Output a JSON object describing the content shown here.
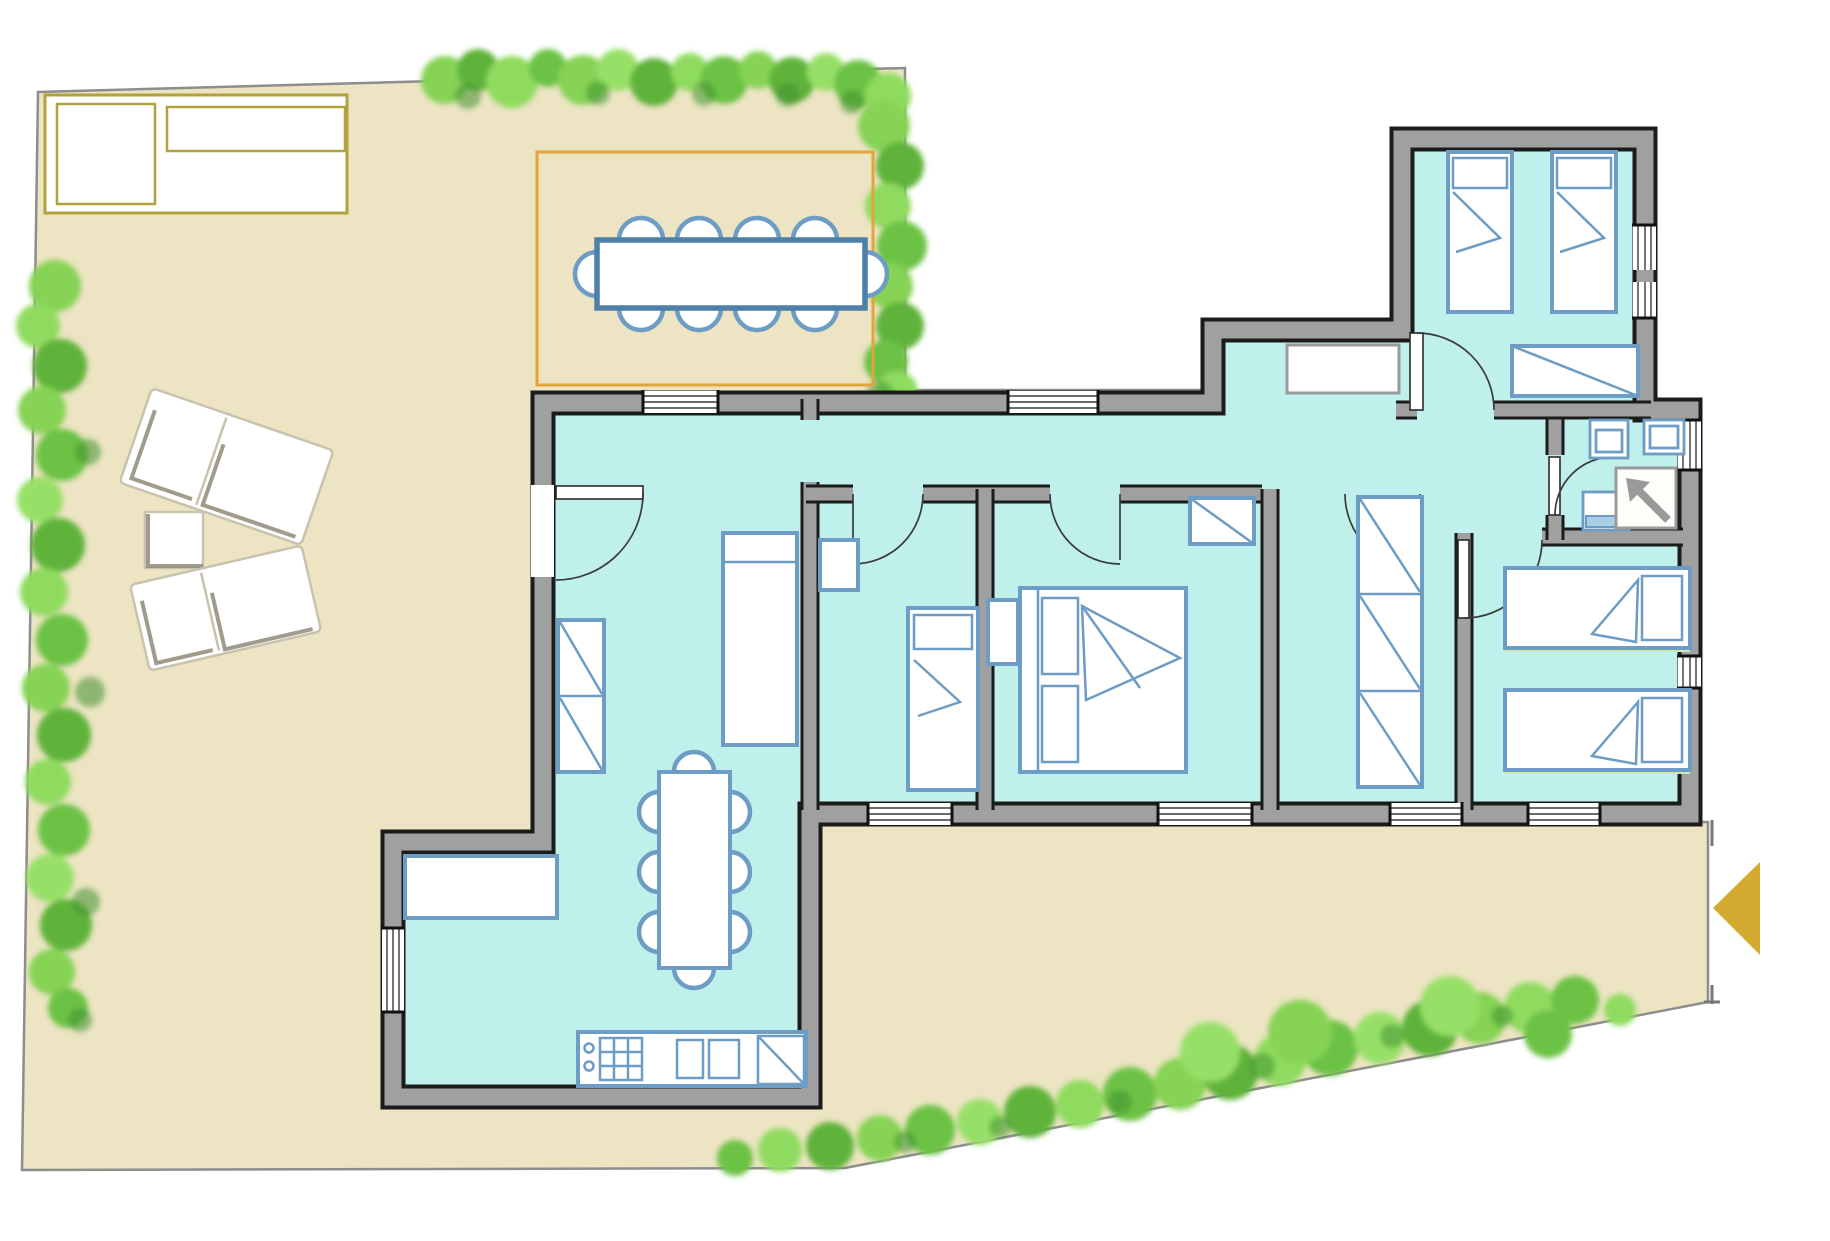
{
  "document": {
    "type": "architectural-floor-plan",
    "title": "Villa ground-floor plan with garden and terraces",
    "visible_text": [],
    "notes": "Hand-tinted style plan: turquoise interior rooms, sand-colored terraces, painterly green hedges, gold entrance arrow at right edge."
  },
  "colors": {
    "page": "#ffffff",
    "terrace": "#ece4c2",
    "boundary": "#8d8d8d",
    "room": "#bff0ec",
    "wall": "#a0a0a0",
    "wall_edge": "#1b1b1b",
    "furniture_blue": "#6d9cc4",
    "furniture_blue_dark": "#4d7fa8",
    "pergola_orange": "#e3a43e",
    "legend_gold": "#b1a23c",
    "arrow_gold": "#d4ab30",
    "hedge_1": "#86d354",
    "hedge_2": "#5fb33a",
    "hedge_3": "#8fdb5f",
    "hedge_4": "#6cc244",
    "hedge_5": "#97e067",
    "hedge_dark": "#3f9230",
    "lounger_edge": "#c8c3ae",
    "lounger_shadow": "#8f8b79",
    "bed_shadow": "#cfe8ad",
    "fixture_fill": "#a9cfe6",
    "shower_gray": "#9a9a9a"
  },
  "legend": {
    "boxes": [
      "empty-key-square",
      "empty-title-bar"
    ]
  },
  "outdoor": {
    "garden_terrace": "sand-colored paved terrace wrapping west and south of the house",
    "pergola_dining": {
      "table": "rectangular outdoor dining table",
      "chairs": 10,
      "border": "orange pergola outline"
    },
    "sun_loungers": 2,
    "side_table": 1,
    "hedges": [
      "top band",
      "north-east column",
      "west column",
      "south-east band"
    ],
    "entrance_marker": {
      "shape": "triangle",
      "direction": "left",
      "color_key": "arrow_gold"
    }
  },
  "rooms": [
    {
      "name": "living-room",
      "furniture": [
        "wall-wardrobe",
        "daybed",
        "dining-table-8-chairs",
        "sofa",
        "kitchen-counter-with-stove-and-sink"
      ]
    },
    {
      "name": "small-bedroom",
      "furniture": [
        "single-bed",
        "nightstand"
      ]
    },
    {
      "name": "master-bedroom",
      "furniture": [
        "double-bed",
        "nightstand",
        "closet"
      ]
    },
    {
      "name": "wardrobe-bedroom",
      "furniture": [
        "triple-wardrobe-column"
      ]
    },
    {
      "name": "right-twin-bedroom",
      "furniture": [
        "single-bed",
        "single-bed"
      ]
    },
    {
      "name": "bathroom",
      "furniture": [
        "washbasin",
        "toilet",
        "bidet",
        "shower-with-arrow"
      ]
    },
    {
      "name": "top-right-twin-bedroom",
      "furniture": [
        "single-bed",
        "single-bed",
        "wardrobe"
      ]
    },
    {
      "name": "hallway",
      "furniture": [
        "built-in-closet"
      ]
    }
  ]
}
